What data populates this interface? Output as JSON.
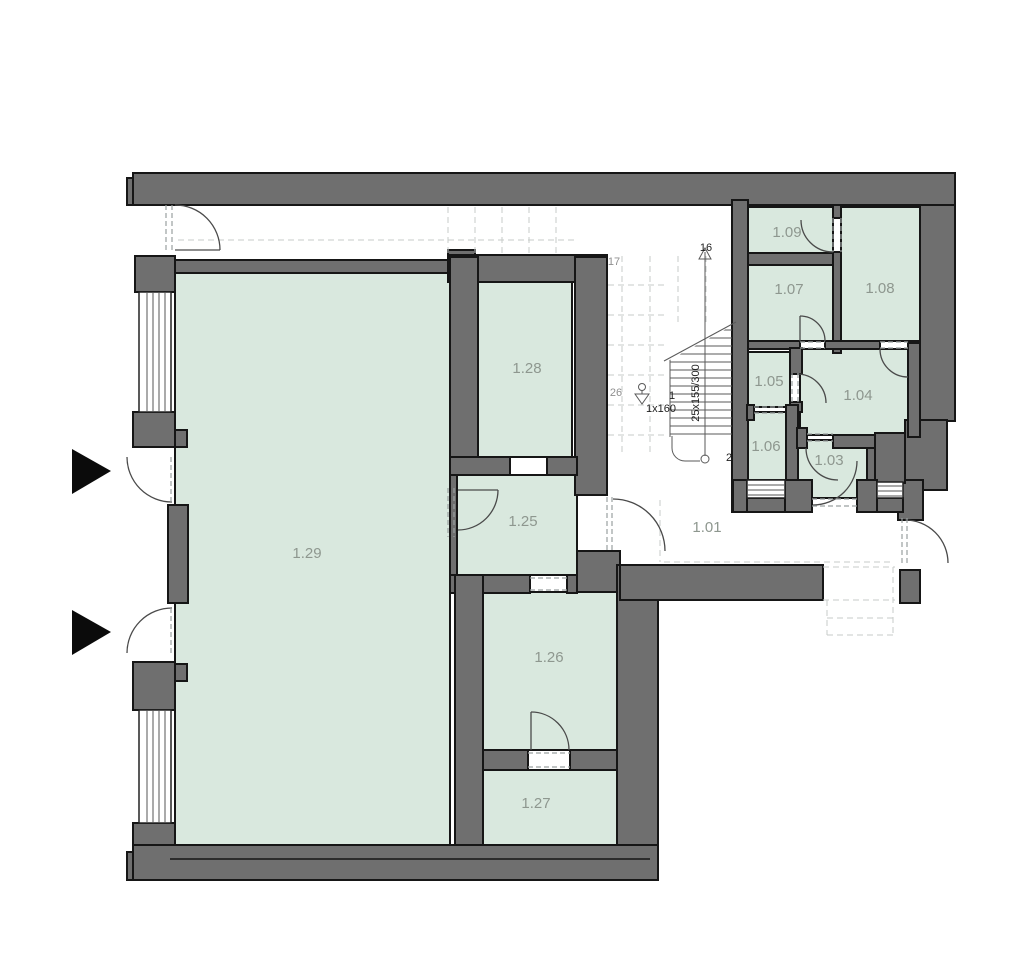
{
  "colors": {
    "wall": "#6f6f6f",
    "line": "#161616",
    "room": "#d9e8de",
    "label": "#8e978f",
    "door": "#4a4a4a",
    "dash": "#9aa0a0",
    "proj": "#c7cbc9",
    "stair": "#5a5a5a",
    "glaze": "#555555",
    "frame": "#222222",
    "ann": "#1f1f1f",
    "anng": "#8f8f8f"
  },
  "plan": {
    "rooms": {
      "r101": {
        "label": "1.01"
      },
      "r103": {
        "label": "1.03"
      },
      "r104": {
        "label": "1.04"
      },
      "r105": {
        "label": "1.05"
      },
      "r106": {
        "label": "1.06"
      },
      "r107": {
        "label": "1.07"
      },
      "r108": {
        "label": "1.08"
      },
      "r109": {
        "label": "1.09"
      },
      "r125": {
        "label": "1.25"
      },
      "r126": {
        "label": "1.26"
      },
      "r127": {
        "label": "1.27"
      },
      "r128": {
        "label": "1.28"
      },
      "r129": {
        "label": "1.29"
      }
    },
    "stair": {
      "top_step": "16",
      "upper_step": "17",
      "landing_step": "26",
      "first_step": "1",
      "second_step": "2",
      "first_riser": "1x160",
      "flight_spec": "25x155/300"
    }
  }
}
